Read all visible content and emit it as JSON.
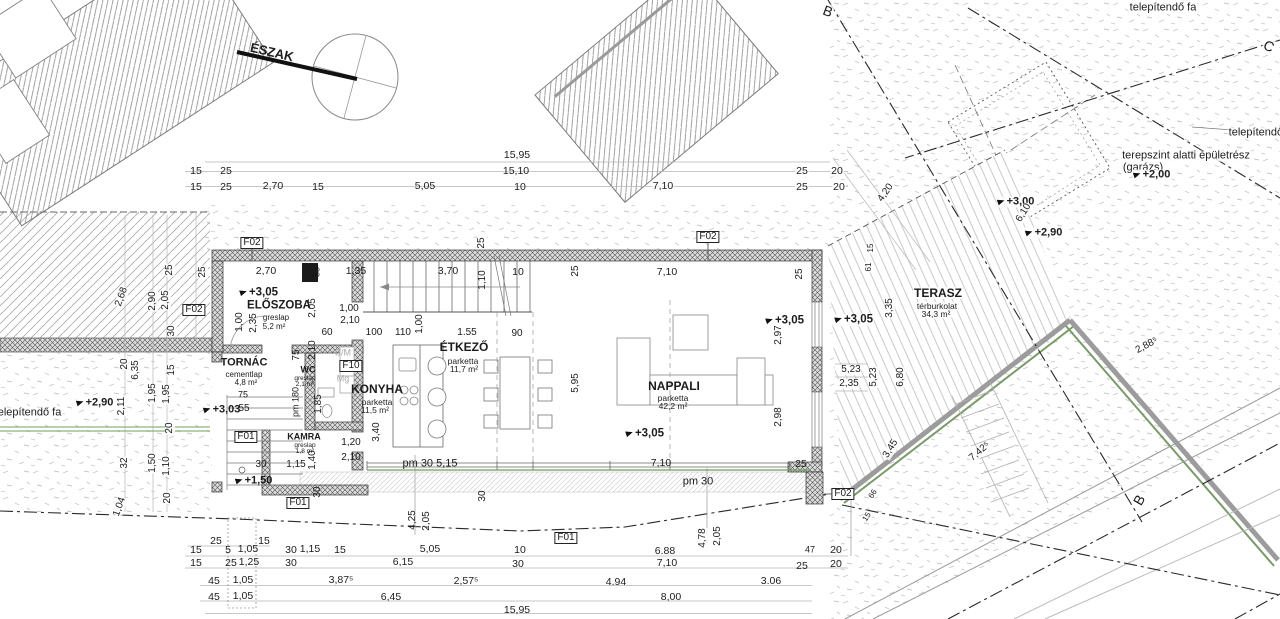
{
  "drawing": {
    "type": "floor-plan",
    "north_label": "ÉSZAK",
    "section_markers": [
      "B",
      "B",
      "C"
    ],
    "rooms": [
      {
        "name": "ELŐSZOBA",
        "finish": "greslap",
        "area": "5,2 m²"
      },
      {
        "name": "TORNÁC",
        "finish": "cementlap",
        "area": "4,8 m²"
      },
      {
        "name": "WC",
        "finish": "greslap",
        "area": "2,1 m²"
      },
      {
        "name": "KONYHA",
        "finish": "parketta",
        "area": "11,5 m²"
      },
      {
        "name": "KAMRA",
        "finish": "greslap",
        "area": "1,8 m²"
      },
      {
        "name": "ÉTKEZŐ",
        "finish": "parketta",
        "area": "11,7 m²"
      },
      {
        "name": "NAPPALI",
        "finish": "parketta",
        "area": "42,2 m²"
      },
      {
        "name": "TERASZ",
        "finish": "térburkolat",
        "area": "34,3 m²"
      }
    ],
    "levels": [
      "+3,05",
      "+3,03",
      "+3,00",
      "+2,90",
      "+2,00",
      "+1,50"
    ],
    "opening_codes": [
      "F01",
      "F02",
      "F10"
    ],
    "site_texts": [
      "telepítendő fa",
      "terepszint alatti épületrész",
      "(garázs)"
    ],
    "appliance_codes": [
      "S/M",
      "Mg"
    ]
  },
  "annotations": [
    {
      "t": "ÉSZAK",
      "x": 272,
      "y": 52,
      "r": 13,
      "s": 13,
      "b": 1,
      "n": "north-label"
    },
    {
      "t": "telepítendő fa",
      "x": 1163,
      "y": 8,
      "s": 11,
      "k": "w",
      "n": "site-text-tree-top"
    },
    {
      "t": "B",
      "x": 828,
      "y": 11,
      "r": 20,
      "s": 14,
      "k": "w",
      "n": "section-marker-b-top"
    },
    {
      "t": "C",
      "x": 1269,
      "y": 46,
      "r": 25,
      "s": 14,
      "k": "w",
      "n": "section-marker-c"
    },
    {
      "t": "telepítendő fa",
      "x": 1262,
      "y": 133,
      "s": 11,
      "k": "w",
      "n": "site-text-tree-right"
    },
    {
      "t": "terepszint alatti épületrész",
      "x": 1186,
      "y": 156,
      "s": 11,
      "k": "w",
      "n": "site-text-basement"
    },
    {
      "t": "(garázs)",
      "x": 1143,
      "y": 168,
      "s": 11,
      "k": "w",
      "n": "site-text-garage"
    },
    {
      "t": "+2,00",
      "x": 1152,
      "y": 175,
      "s": 11,
      "b": 1,
      "k": "lvl w",
      "n": "level-marker"
    },
    {
      "t": "+3,00",
      "x": 1016,
      "y": 202,
      "s": 11,
      "b": 1,
      "k": "lvl w",
      "n": "level-marker"
    },
    {
      "t": "+2,90",
      "x": 1044,
      "y": 233,
      "s": 11,
      "b": 1,
      "k": "lvl w",
      "n": "level-marker"
    },
    {
      "t": "6,10",
      "x": 1024,
      "y": 213,
      "r": -58,
      "k": "w"
    },
    {
      "t": "4,20",
      "x": 886,
      "y": 193,
      "r": -55,
      "k": "w"
    },
    {
      "t": "15,95",
      "x": 517,
      "y": 155,
      "s": 10.5
    },
    {
      "t": "15,10",
      "x": 516,
      "y": 171,
      "s": 10.5
    },
    {
      "t": "15",
      "x": 196,
      "y": 171,
      "s": 10.5
    },
    {
      "t": "25",
      "x": 226,
      "y": 171,
      "s": 10.5
    },
    {
      "t": "25",
      "x": 802,
      "y": 171,
      "s": 10.5,
      "k": "w"
    },
    {
      "t": "20",
      "x": 837,
      "y": 171,
      "s": 10.5,
      "k": "w"
    },
    {
      "t": "15",
      "x": 196,
      "y": 187,
      "s": 10.5
    },
    {
      "t": "25",
      "x": 226,
      "y": 187,
      "s": 10.5
    },
    {
      "t": "2,70",
      "x": 273,
      "y": 186,
      "s": 10.5
    },
    {
      "t": "15",
      "x": 318,
      "y": 187,
      "s": 10.5
    },
    {
      "t": "5,05",
      "x": 425,
      "y": 186,
      "s": 10.5
    },
    {
      "t": "10",
      "x": 520,
      "y": 187,
      "s": 10.5
    },
    {
      "t": "7,10",
      "x": 663,
      "y": 186,
      "s": 10.5,
      "k": "w"
    },
    {
      "t": "25",
      "x": 802,
      "y": 187,
      "s": 10.5,
      "k": "w"
    },
    {
      "t": "20",
      "x": 839,
      "y": 187,
      "s": 10.5,
      "k": "w"
    },
    {
      "t": "2,68",
      "x": 122,
      "y": 297,
      "r": -70,
      "k": "w"
    },
    {
      "t": "2,90",
      "x": 153,
      "y": 301,
      "r": -90,
      "k": "w"
    },
    {
      "t": "2,05",
      "x": 166,
      "y": 300,
      "r": -90,
      "k": "w"
    },
    {
      "t": "25",
      "x": 170,
      "y": 270,
      "r": -90,
      "k": "w"
    },
    {
      "t": "25",
      "x": 203,
      "y": 272,
      "r": -90,
      "k": "w"
    },
    {
      "t": "F02",
      "x": 194,
      "y": 310,
      "k": "box",
      "n": "opening-label-f02"
    },
    {
      "t": "30",
      "x": 172,
      "y": 331,
      "r": -90,
      "k": "w"
    },
    {
      "t": "20",
      "x": 125,
      "y": 364,
      "r": -90,
      "k": "w"
    },
    {
      "t": "6,35",
      "x": 136,
      "y": 370,
      "r": -90,
      "k": "w"
    },
    {
      "t": "15",
      "x": 172,
      "y": 370,
      "r": -90,
      "k": "w"
    },
    {
      "t": "2,11",
      "x": 122,
      "y": 406,
      "r": -90,
      "k": "w"
    },
    {
      "t": "1,95",
      "x": 153,
      "y": 393,
      "r": -90,
      "k": "w"
    },
    {
      "t": "1,95",
      "x": 167,
      "y": 394,
      "r": -90,
      "k": "w"
    },
    {
      "t": "20",
      "x": 170,
      "y": 428,
      "r": -90,
      "k": "w"
    },
    {
      "t": "32",
      "x": 125,
      "y": 463,
      "r": -90,
      "k": "w"
    },
    {
      "t": "1,50",
      "x": 153,
      "y": 463,
      "r": -90,
      "k": "w"
    },
    {
      "t": "1,10",
      "x": 167,
      "y": 466,
      "r": -90,
      "k": "w"
    },
    {
      "t": "20",
      "x": 168,
      "y": 498,
      "r": -90,
      "k": "w"
    },
    {
      "t": "1,04",
      "x": 120,
      "y": 507,
      "r": -70,
      "k": "w"
    },
    {
      "t": "telepítendő fa",
      "x": 28,
      "y": 413,
      "s": 11,
      "k": "w",
      "n": "site-text-tree-left"
    },
    {
      "t": "+2,90",
      "x": 95,
      "y": 403,
      "s": 11,
      "b": 1,
      "k": "lvl w",
      "n": "level-marker"
    },
    {
      "t": "F02",
      "x": 252,
      "y": 243,
      "k": "box",
      "n": "opening-label-f02"
    },
    {
      "t": "F02",
      "x": 708,
      "y": 237,
      "k": "box",
      "n": "opening-label-f02"
    },
    {
      "t": "2,70",
      "x": 266,
      "y": 271,
      "s": 10.5
    },
    {
      "t": "35",
      "x": 317,
      "y": 272,
      "r": -90,
      "s": 9
    },
    {
      "t": "1,35",
      "x": 356,
      "y": 271,
      "s": 10.5
    },
    {
      "t": "3,70",
      "x": 448,
      "y": 271,
      "s": 10.5
    },
    {
      "t": "1,10",
      "x": 483,
      "y": 280,
      "r": -90
    },
    {
      "t": "10",
      "x": 518,
      "y": 272,
      "s": 10.5
    },
    {
      "t": "25",
      "x": 482,
      "y": 243,
      "r": -90,
      "k": "w"
    },
    {
      "t": "25",
      "x": 576,
      "y": 271,
      "r": -90
    },
    {
      "t": "7,10",
      "x": 667,
      "y": 272,
      "s": 10.5
    },
    {
      "t": "25",
      "x": 800,
      "y": 274,
      "r": -90
    },
    {
      "t": "+3,05",
      "x": 259,
      "y": 293,
      "s": 11.5,
      "b": 1,
      "k": "lvl",
      "n": "level-marker"
    },
    {
      "t": "ELŐSZOBA",
      "x": 279,
      "y": 306,
      "s": 11.5,
      "b": 1,
      "n": "room-label-eloszoba"
    },
    {
      "t": "greslap",
      "x": 276,
      "y": 318,
      "s": 8
    },
    {
      "t": "5,2 m²",
      "x": 274,
      "y": 327,
      "s": 8
    },
    {
      "t": "2,05",
      "x": 313,
      "y": 308,
      "r": -90
    },
    {
      "t": "1,00",
      "x": 349,
      "y": 309
    },
    {
      "t": "2,10",
      "x": 350,
      "y": 321
    },
    {
      "t": "60",
      "x": 327,
      "y": 333
    },
    {
      "t": "100",
      "x": 374,
      "y": 333
    },
    {
      "t": "110",
      "x": 403,
      "y": 333
    },
    {
      "t": "1,00",
      "x": 420,
      "y": 324,
      "r": -90
    },
    {
      "t": "1.55",
      "x": 467,
      "y": 333
    },
    {
      "t": "90",
      "x": 517,
      "y": 334
    },
    {
      "t": "1,00",
      "x": 240,
      "y": 322,
      "r": -90
    },
    {
      "t": "2,35",
      "x": 254,
      "y": 323,
      "r": -90
    },
    {
      "t": "TORNÁC",
      "x": 244,
      "y": 363,
      "s": 11,
      "b": 1,
      "n": "room-label-tornac"
    },
    {
      "t": "cementlap",
      "x": 244,
      "y": 375,
      "s": 8
    },
    {
      "t": "4,8 m²",
      "x": 246,
      "y": 383,
      "s": 8
    },
    {
      "t": "75",
      "x": 297,
      "y": 355,
      "r": -90
    },
    {
      "t": "2,10",
      "x": 313,
      "y": 350,
      "r": -90
    },
    {
      "t": "WC",
      "x": 308,
      "y": 370,
      "s": 9,
      "b": 1,
      "n": "room-label-wc"
    },
    {
      "t": "greslap",
      "x": 305,
      "y": 379,
      "s": 6.5
    },
    {
      "t": "2,1 m²",
      "x": 305,
      "y": 385,
      "s": 6.5
    },
    {
      "t": "S/M",
      "x": 343,
      "y": 353,
      "s": 9,
      "k": "gray",
      "n": "appliance-label"
    },
    {
      "t": "F10",
      "x": 351,
      "y": 366,
      "k": "box",
      "n": "opening-label-f10"
    },
    {
      "t": "Mg",
      "x": 343,
      "y": 379,
      "s": 9,
      "k": "gray",
      "n": "appliance-label"
    },
    {
      "t": "KONYHA",
      "x": 377,
      "y": 389,
      "s": 12,
      "b": 1,
      "n": "room-label-konyha"
    },
    {
      "t": "parketta",
      "x": 377,
      "y": 402,
      "s": 8.5
    },
    {
      "t": "11,5 m²",
      "x": 375,
      "y": 410,
      "s": 8.5
    },
    {
      "t": "+3,03",
      "x": 222,
      "y": 410,
      "s": 11,
      "b": 1,
      "k": "lvl",
      "n": "level-marker"
    },
    {
      "t": "75",
      "x": 243,
      "y": 395,
      "s": 9
    },
    {
      "t": "55",
      "x": 244,
      "y": 409
    },
    {
      "t": "pm 180",
      "x": 296,
      "y": 402,
      "r": -90,
      "s": 9
    },
    {
      "t": "1,85",
      "x": 319,
      "y": 404,
      "r": -90
    },
    {
      "t": "F01",
      "x": 246,
      "y": 437,
      "k": "box",
      "n": "opening-label-f01"
    },
    {
      "t": "KAMRA",
      "x": 304,
      "y": 437,
      "s": 9,
      "b": 1,
      "n": "room-label-kamra"
    },
    {
      "t": "greslap",
      "x": 305,
      "y": 446,
      "s": 6.5
    },
    {
      "t": "1,8 m²",
      "x": 305,
      "y": 452,
      "s": 6.5
    },
    {
      "t": "1,15",
      "x": 296,
      "y": 465
    },
    {
      "t": "1,40",
      "x": 313,
      "y": 460,
      "r": -90
    },
    {
      "t": "30",
      "x": 261,
      "y": 465
    },
    {
      "t": "+1,50",
      "x": 254,
      "y": 481,
      "s": 11,
      "b": 1,
      "k": "lvl",
      "n": "level-marker"
    },
    {
      "t": "1,20",
      "x": 351,
      "y": 443
    },
    {
      "t": "2,10",
      "x": 351,
      "y": 458
    },
    {
      "t": "3,40",
      "x": 377,
      "y": 432,
      "r": -90
    },
    {
      "t": "ÉTKEZŐ",
      "x": 464,
      "y": 347,
      "s": 12,
      "b": 1,
      "n": "room-label-etkezo"
    },
    {
      "t": "parketta",
      "x": 463,
      "y": 361,
      "s": 8.5
    },
    {
      "t": "11,7 m²",
      "x": 464,
      "y": 369,
      "s": 8.5
    },
    {
      "t": "pm 30 5,15",
      "x": 430,
      "y": 464,
      "s": 11
    },
    {
      "t": "5,95",
      "x": 576,
      "y": 383,
      "r": -90
    },
    {
      "t": "NAPPALI",
      "x": 674,
      "y": 386,
      "s": 12,
      "b": 1,
      "n": "room-label-nappali"
    },
    {
      "t": "parketta",
      "x": 673,
      "y": 398,
      "s": 8.5
    },
    {
      "t": "42,2 m²",
      "x": 673,
      "y": 406,
      "s": 8.5
    },
    {
      "t": "+3,05",
      "x": 645,
      "y": 434,
      "s": 11.5,
      "b": 1,
      "k": "lvl",
      "n": "level-marker"
    },
    {
      "t": "+3,05",
      "x": 785,
      "y": 321,
      "s": 11.5,
      "b": 1,
      "k": "lvl",
      "n": "level-marker"
    },
    {
      "t": "+3,05",
      "x": 854,
      "y": 320,
      "s": 11.5,
      "b": 1,
      "k": "lvl w",
      "n": "level-marker"
    },
    {
      "t": "2,97",
      "x": 779,
      "y": 335,
      "r": -90
    },
    {
      "t": "2,98",
      "x": 779,
      "y": 417,
      "r": -90
    },
    {
      "t": "7,10",
      "x": 661,
      "y": 463,
      "s": 10.5
    },
    {
      "t": "25",
      "x": 801,
      "y": 464,
      "s": 10.5
    },
    {
      "t": "pm 30",
      "x": 698,
      "y": 482,
      "s": 11
    },
    {
      "t": "30",
      "x": 483,
      "y": 496,
      "r": -90
    },
    {
      "t": "30",
      "x": 318,
      "y": 492,
      "r": -90
    },
    {
      "t": "F01",
      "x": 298,
      "y": 503,
      "k": "box",
      "n": "opening-label-f01"
    },
    {
      "t": "4,25",
      "x": 413,
      "y": 520,
      "r": -90
    },
    {
      "t": "2,05",
      "x": 427,
      "y": 521,
      "r": -90
    },
    {
      "t": "F02",
      "x": 843,
      "y": 494,
      "k": "box",
      "n": "opening-label-f02"
    },
    {
      "t": "F01",
      "x": 566,
      "y": 538,
      "k": "box",
      "n": "opening-label-f01"
    },
    {
      "t": "TERASZ",
      "x": 938,
      "y": 293,
      "s": 12,
      "b": 1,
      "k": "w",
      "n": "room-label-terasz"
    },
    {
      "t": "térburkolat",
      "x": 937,
      "y": 306,
      "s": 8.5,
      "k": "w"
    },
    {
      "t": "34,3 m²",
      "x": 936,
      "y": 314,
      "s": 8.5,
      "k": "w"
    },
    {
      "t": "3,35",
      "x": 890,
      "y": 308,
      "r": -90,
      "k": "w"
    },
    {
      "t": "15",
      "x": 871,
      "y": 248,
      "r": -90,
      "s": 8,
      "k": "w"
    },
    {
      "t": "61",
      "x": 869,
      "y": 267,
      "r": -90,
      "s": 8,
      "k": "w"
    },
    {
      "t": "5,23",
      "x": 851,
      "y": 370,
      "k": "w"
    },
    {
      "t": "2,35",
      "x": 849,
      "y": 384,
      "k": "w"
    },
    {
      "t": "5,23",
      "x": 874,
      "y": 377,
      "r": -90,
      "k": "w"
    },
    {
      "t": "6,80",
      "x": 901,
      "y": 377,
      "r": -90,
      "k": "w"
    },
    {
      "t": "3,45",
      "x": 891,
      "y": 449,
      "r": -58,
      "k": "w"
    },
    {
      "t": "66",
      "x": 873,
      "y": 494,
      "r": -58,
      "s": 8,
      "k": "w"
    },
    {
      "t": "15",
      "x": 867,
      "y": 517,
      "r": -58,
      "s": 8,
      "k": "w"
    },
    {
      "t": "7,42⁵",
      "x": 980,
      "y": 452,
      "r": -40,
      "k": "w"
    },
    {
      "t": "2,88⁵",
      "x": 1147,
      "y": 346,
      "r": -28,
      "k": "w"
    },
    {
      "t": "B",
      "x": 1139,
      "y": 500,
      "r": -60,
      "s": 14,
      "k": "w",
      "n": "section-marker-b-right"
    },
    {
      "t": "25",
      "x": 216,
      "y": 541,
      "s": 10.5
    },
    {
      "t": "15",
      "x": 264,
      "y": 541,
      "s": 10.5
    },
    {
      "t": "15",
      "x": 196,
      "y": 550,
      "s": 10.5
    },
    {
      "t": "5",
      "x": 228,
      "y": 550,
      "s": 10.5
    },
    {
      "t": "1,05",
      "x": 248,
      "y": 549,
      "s": 10.5
    },
    {
      "t": "30",
      "x": 291,
      "y": 550,
      "s": 10.5
    },
    {
      "t": "1,15",
      "x": 310,
      "y": 549,
      "s": 10.5
    },
    {
      "t": "15",
      "x": 340,
      "y": 550,
      "s": 10.5
    },
    {
      "t": "5,05",
      "x": 430,
      "y": 549,
      "s": 10.5
    },
    {
      "t": "10",
      "x": 520,
      "y": 550,
      "s": 10.5
    },
    {
      "t": "6.88",
      "x": 665,
      "y": 551,
      "s": 10.5
    },
    {
      "t": "47",
      "x": 810,
      "y": 550,
      "s": 9
    },
    {
      "t": "20",
      "x": 836,
      "y": 550,
      "s": 10.5
    },
    {
      "t": "15",
      "x": 196,
      "y": 563,
      "s": 10.5
    },
    {
      "t": "25",
      "x": 231,
      "y": 563,
      "s": 10.5
    },
    {
      "t": "1,25",
      "x": 249,
      "y": 562,
      "s": 10.5
    },
    {
      "t": "30",
      "x": 291,
      "y": 563,
      "s": 10.5
    },
    {
      "t": "6,15",
      "x": 403,
      "y": 562,
      "s": 10.5
    },
    {
      "t": "30",
      "x": 518,
      "y": 564,
      "s": 10.5
    },
    {
      "t": "7,10",
      "x": 667,
      "y": 563,
      "s": 10.5
    },
    {
      "t": "25",
      "x": 802,
      "y": 566,
      "s": 10.5
    },
    {
      "t": "20",
      "x": 836,
      "y": 564,
      "s": 10.5
    },
    {
      "t": "45",
      "x": 214,
      "y": 581,
      "s": 10.5
    },
    {
      "t": "1,05",
      "x": 243,
      "y": 580,
      "s": 10.5
    },
    {
      "t": "3,87⁵",
      "x": 341,
      "y": 580,
      "s": 10.5
    },
    {
      "t": "2,57⁵",
      "x": 466,
      "y": 581,
      "s": 10.5
    },
    {
      "t": "4.94",
      "x": 616,
      "y": 582,
      "s": 10.5
    },
    {
      "t": "3.06",
      "x": 771,
      "y": 581,
      "s": 10.5
    },
    {
      "t": "45",
      "x": 214,
      "y": 597,
      "s": 10.5
    },
    {
      "t": "1,05",
      "x": 243,
      "y": 596,
      "s": 10.5
    },
    {
      "t": "6,45",
      "x": 391,
      "y": 597,
      "s": 10.5
    },
    {
      "t": "8,00",
      "x": 671,
      "y": 597,
      "s": 10.5
    },
    {
      "t": "15,95",
      "x": 517,
      "y": 610,
      "s": 10.5
    },
    {
      "t": "4,78",
      "x": 703,
      "y": 538,
      "r": -90,
      "k": "w"
    },
    {
      "t": "2,05",
      "x": 718,
      "y": 536,
      "r": -90,
      "k": "w"
    }
  ]
}
